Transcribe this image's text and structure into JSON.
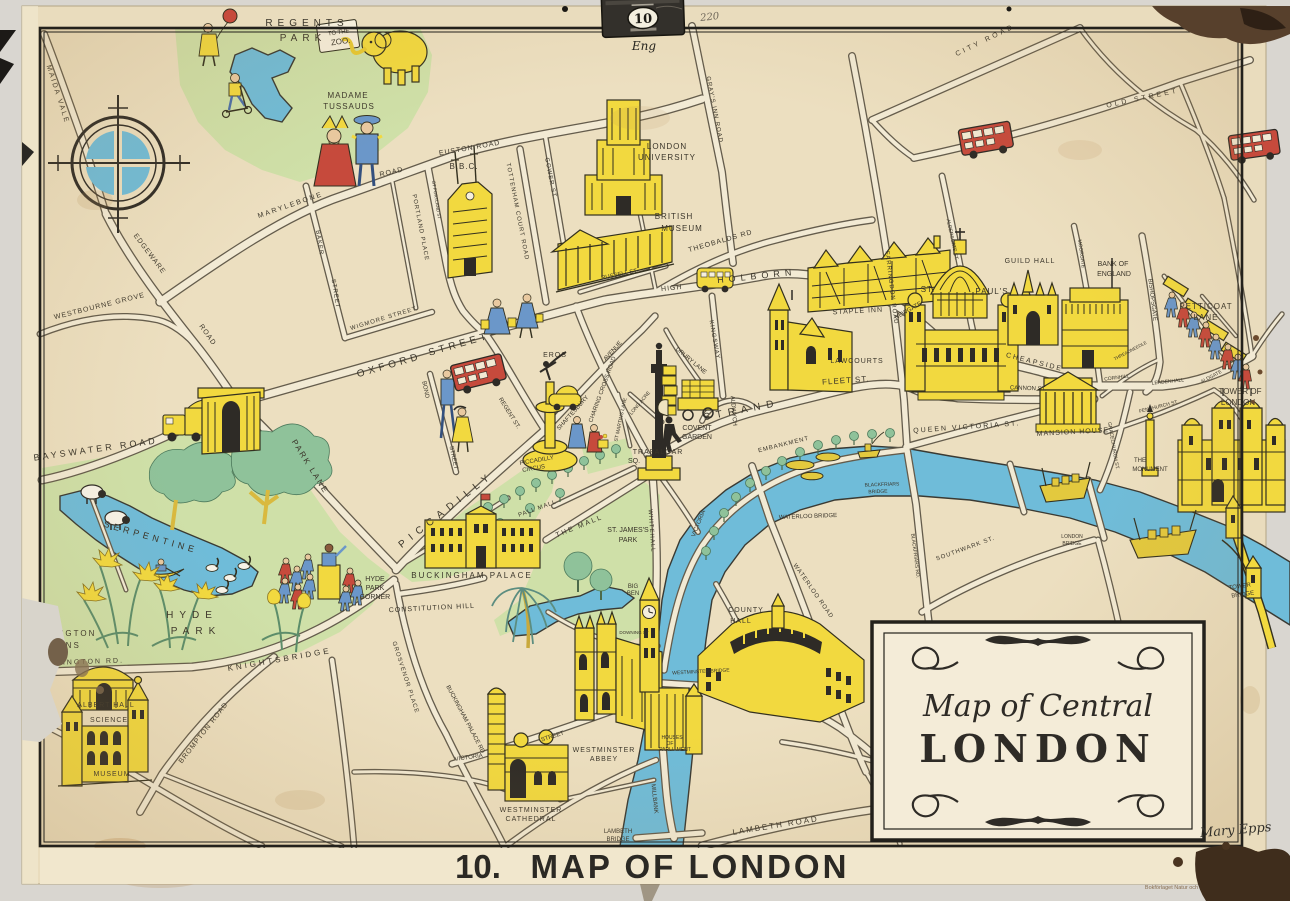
{
  "poster": {
    "hanger": {
      "number": "10",
      "note": "Eng",
      "pencil": "220"
    },
    "caption": {
      "number": "10.",
      "text": "MAP OF LONDON"
    },
    "cartouche": {
      "line1": "Map of Central",
      "line2": "LONDON"
    },
    "signature": "Mary Epps",
    "imprint": "A.B. KOPIA STOCKHOLM",
    "publisher": "Bokförlaget Natur och Kultur engelska planscherna"
  },
  "map": {
    "colors": {
      "cream": "#e9dcbd",
      "road": "#f2ead4",
      "park": "#cfe0a8",
      "water": "#6fbcd9",
      "landmark_yellow": "#f2d93f",
      "bus_red": "#c64a3c",
      "ink": "#3a352a"
    },
    "labels": [
      {
        "t": "REGENTS",
        "x": 307,
        "y": 26,
        "r": 0,
        "s": 10,
        "ls": 5
      },
      {
        "t": "PARK",
        "x": 303,
        "y": 41,
        "r": 0,
        "s": 10,
        "ls": 5
      },
      {
        "t": "TO THE",
        "x": 339,
        "y": 34,
        "r": -8,
        "s": 6,
        "ls": 0
      },
      {
        "t": "ZOO.",
        "x": 341,
        "y": 44,
        "r": -8,
        "s": 8,
        "ls": 0
      },
      {
        "t": "MADAME",
        "x": 348,
        "y": 98,
        "r": 0,
        "s": 8,
        "ls": 1
      },
      {
        "t": "TUSSAUDS",
        "x": 349,
        "y": 109,
        "r": 0,
        "s": 8,
        "ls": 1
      },
      {
        "t": "B.B.C.",
        "x": 464,
        "y": 169,
        "r": 0,
        "s": 8,
        "ls": 1
      },
      {
        "t": "LONDON",
        "x": 667,
        "y": 149,
        "r": 0,
        "s": 8,
        "ls": 1
      },
      {
        "t": "UNIVERSITY",
        "x": 667,
        "y": 160,
        "r": 0,
        "s": 8,
        "ls": 1
      },
      {
        "t": "BRITISH",
        "x": 674,
        "y": 219,
        "r": 0,
        "s": 8,
        "ls": 1
      },
      {
        "t": "MUSEUM",
        "x": 682,
        "y": 231,
        "r": 0,
        "s": 8,
        "ls": 1
      },
      {
        "t": "STAPLE INN",
        "x": 858,
        "y": 313,
        "r": -3,
        "s": 7,
        "ls": 1
      },
      {
        "t": "LAWCOURTS",
        "x": 857,
        "y": 363,
        "r": 0,
        "s": 7,
        "ls": 1
      },
      {
        "t": "ST.",
        "x": 928,
        "y": 292,
        "r": 0,
        "s": 8,
        "ls": 1
      },
      {
        "t": "PAUL'S",
        "x": 992,
        "y": 294,
        "r": 0,
        "s": 8,
        "ls": 1
      },
      {
        "t": "GUILD HALL",
        "x": 1030,
        "y": 263,
        "r": 0,
        "s": 7,
        "ls": 1
      },
      {
        "t": "BANK OF",
        "x": 1113,
        "y": 266,
        "r": 0,
        "s": 7,
        "ls": 0
      },
      {
        "t": "ENGLAND",
        "x": 1114,
        "y": 276,
        "r": 0,
        "s": 7,
        "ls": 0
      },
      {
        "t": "PETTICOAT",
        "x": 1206,
        "y": 309,
        "r": 0,
        "s": 8,
        "ls": 1
      },
      {
        "t": "LANE",
        "x": 1206,
        "y": 320,
        "r": 0,
        "s": 8,
        "ls": 1
      },
      {
        "t": "TOWER OF",
        "x": 1240,
        "y": 394,
        "r": 0,
        "s": 8,
        "ls": 0
      },
      {
        "t": "LONDON",
        "x": 1238,
        "y": 405,
        "r": 0,
        "s": 8,
        "ls": 0
      },
      {
        "t": "THE",
        "x": 1140,
        "y": 462,
        "r": 0,
        "s": 6,
        "ls": 0
      },
      {
        "t": "MONUMENT",
        "x": 1150,
        "y": 471,
        "r": 0,
        "s": 6,
        "ls": 0
      },
      {
        "t": "MANSION HOUSE",
        "x": 1073,
        "y": 434,
        "r": -3,
        "s": 7,
        "ls": 1
      },
      {
        "t": "COVENT",
        "x": 697,
        "y": 430,
        "r": 0,
        "s": 7,
        "ls": 0
      },
      {
        "t": "GARDEN",
        "x": 697,
        "y": 439,
        "r": 0,
        "s": 7,
        "ls": 0
      },
      {
        "t": "TRAFALGAR",
        "x": 658,
        "y": 454,
        "r": 0,
        "s": 7,
        "ls": 1
      },
      {
        "t": "SQ.",
        "x": 634,
        "y": 463,
        "r": 0,
        "s": 7,
        "ls": 0
      },
      {
        "t": "EROS",
        "x": 555,
        "y": 357,
        "r": 0,
        "s": 7,
        "ls": 1
      },
      {
        "t": "PICCADILLY",
        "x": 537,
        "y": 462,
        "r": -10,
        "s": 6,
        "ls": 0
      },
      {
        "t": "CIRCUS",
        "x": 534,
        "y": 470,
        "r": -10,
        "s": 6,
        "ls": 0
      },
      {
        "t": "HYDE",
        "x": 375,
        "y": 581,
        "r": 0,
        "s": 7,
        "ls": 0
      },
      {
        "t": "PARK",
        "x": 375,
        "y": 590,
        "r": 0,
        "s": 7,
        "ls": 0
      },
      {
        "t": "CORNER",
        "x": 375,
        "y": 599,
        "r": 0,
        "s": 7,
        "ls": 0
      },
      {
        "t": "HYDE",
        "x": 192,
        "y": 618,
        "r": 0,
        "s": 10,
        "ls": 6
      },
      {
        "t": "PARK",
        "x": 196,
        "y": 634,
        "r": 0,
        "s": 10,
        "ls": 6
      },
      {
        "t": "SERPENTINE",
        "x": 150,
        "y": 540,
        "r": 16,
        "s": 9,
        "ls": 4
      },
      {
        "t": "KENSINGTON",
        "x": 60,
        "y": 636,
        "r": 0,
        "s": 8,
        "ls": 2
      },
      {
        "t": "GARDENS",
        "x": 54,
        "y": 648,
        "r": 0,
        "s": 8,
        "ls": 2
      },
      {
        "t": "ST. JAMES'S",
        "x": 628,
        "y": 532,
        "r": 0,
        "s": 7,
        "ls": 0
      },
      {
        "t": "PARK",
        "x": 628,
        "y": 542,
        "r": 0,
        "s": 7,
        "ls": 0
      },
      {
        "t": "BIG",
        "x": 633,
        "y": 588,
        "r": 0,
        "s": 6,
        "ls": 0
      },
      {
        "t": "BEN",
        "x": 633,
        "y": 595,
        "r": 0,
        "s": 6,
        "ls": 0
      },
      {
        "t": "BUCKINGHAM PALACE",
        "x": 472,
        "y": 578,
        "r": 0,
        "s": 8,
        "ls": 2
      },
      {
        "t": "WESTMINSTER",
        "x": 604,
        "y": 752,
        "r": 0,
        "s": 7,
        "ls": 1
      },
      {
        "t": "ABBEY",
        "x": 604,
        "y": 761,
        "r": 0,
        "s": 7,
        "ls": 1
      },
      {
        "t": "HOUSES",
        "x": 672,
        "y": 739,
        "r": 0,
        "s": 5,
        "ls": 0
      },
      {
        "t": "OF",
        "x": 670,
        "y": 745,
        "r": 0,
        "s": 5,
        "ls": 0
      },
      {
        "t": "PARLIAMENT",
        "x": 675,
        "y": 751,
        "r": 0,
        "s": 5,
        "ls": 0
      },
      {
        "t": "WESTMINSTER",
        "x": 531,
        "y": 812,
        "r": 0,
        "s": 7,
        "ls": 1
      },
      {
        "t": "CATHEDRAL",
        "x": 531,
        "y": 821,
        "r": 0,
        "s": 7,
        "ls": 1
      },
      {
        "t": "COUNTY",
        "x": 746,
        "y": 612,
        "r": 0,
        "s": 7,
        "ls": 1
      },
      {
        "t": "HALL",
        "x": 741,
        "y": 623,
        "r": 0,
        "s": 7,
        "ls": 1
      },
      {
        "t": "ALBERT HALL",
        "x": 106,
        "y": 707,
        "r": 0,
        "s": 7,
        "ls": 1
      },
      {
        "t": "SCIENCE",
        "x": 109,
        "y": 722,
        "r": 0,
        "s": 7,
        "ls": 1
      },
      {
        "t": "MUSEUM",
        "x": 112,
        "y": 776,
        "r": 0,
        "s": 7,
        "ls": 1
      },
      {
        "t": "TOWER",
        "x": 1240,
        "y": 588,
        "r": -8,
        "s": 6,
        "ls": 0
      },
      {
        "t": "BRIDGE",
        "x": 1243,
        "y": 596,
        "r": -8,
        "s": 6,
        "ls": 0
      },
      {
        "t": "MAIDA VALE",
        "x": 56,
        "y": 95,
        "r": 72,
        "s": 7,
        "ls": 2
      },
      {
        "t": "WESTBOURNE GROVE",
        "x": 100,
        "y": 308,
        "r": -14,
        "s": 7,
        "ls": 1
      },
      {
        "t": "EDGEWARE",
        "x": 148,
        "y": 255,
        "r": 53,
        "s": 7,
        "ls": 1
      },
      {
        "t": "ROAD",
        "x": 206,
        "y": 336,
        "r": 55,
        "s": 7,
        "ls": 1
      },
      {
        "t": "MARYLEBONE",
        "x": 291,
        "y": 207,
        "r": -19,
        "s": 7,
        "ls": 2
      },
      {
        "t": "ROAD",
        "x": 392,
        "y": 174,
        "r": -13,
        "s": 7,
        "ls": 1
      },
      {
        "t": "EUSTON ROAD",
        "x": 470,
        "y": 150,
        "r": -10,
        "s": 7,
        "ls": 1
      },
      {
        "t": "BAKER",
        "x": 318,
        "y": 243,
        "r": 81,
        "s": 6,
        "ls": 1
      },
      {
        "t": "STREET",
        "x": 334,
        "y": 294,
        "r": 81,
        "s": 6,
        "ls": 1
      },
      {
        "t": "GT PORTLAND ST",
        "x": 435,
        "y": 200,
        "r": 81,
        "s": 4.5,
        "ls": 0
      },
      {
        "t": "PORTLAND PLACE",
        "x": 419,
        "y": 228,
        "r": 79,
        "s": 6,
        "ls": 1
      },
      {
        "t": "TOTTENHAM COURT ROAD",
        "x": 516,
        "y": 212,
        "r": 79,
        "s": 6,
        "ls": 1
      },
      {
        "t": "GOWER ST",
        "x": 549,
        "y": 178,
        "r": 79,
        "s": 6,
        "ls": 1
      },
      {
        "t": "WIGMORE STREET",
        "x": 384,
        "y": 320,
        "r": -17,
        "s": 6,
        "ls": 1
      },
      {
        "t": "OXFORD",
        "x": 390,
        "y": 368,
        "r": -16,
        "s": 10,
        "ls": 4
      },
      {
        "t": "STREET",
        "x": 460,
        "y": 347,
        "r": -16,
        "s": 10,
        "ls": 4
      },
      {
        "t": "BOND",
        "x": 424,
        "y": 390,
        "r": 78,
        "s": 6,
        "ls": 0
      },
      {
        "t": "STREET",
        "x": 452,
        "y": 458,
        "r": 78,
        "s": 6,
        "ls": 0
      },
      {
        "t": "REGENT ST.",
        "x": 508,
        "y": 414,
        "r": 58,
        "s": 6,
        "ls": 0
      },
      {
        "t": "SHAFTESBURY",
        "x": 574,
        "y": 414,
        "r": -48,
        "s": 6,
        "ls": 0
      },
      {
        "t": "AVENUE",
        "x": 614,
        "y": 352,
        "r": -48,
        "s": 6,
        "ls": 0
      },
      {
        "t": "CHARING CROSS ROAD",
        "x": 604,
        "y": 390,
        "r": -70,
        "s": 6,
        "ls": 0
      },
      {
        "t": "ST MARTINS LANE",
        "x": 622,
        "y": 420,
        "r": -78,
        "s": 5,
        "ls": 0
      },
      {
        "t": "LONG ACRE",
        "x": 641,
        "y": 404,
        "r": -50,
        "s": 5,
        "ls": 0
      },
      {
        "t": "DRURY LANE",
        "x": 690,
        "y": 362,
        "r": 40,
        "s": 6,
        "ls": 0
      },
      {
        "t": "KINGSWAY",
        "x": 713,
        "y": 340,
        "r": 80,
        "s": 6,
        "ls": 1
      },
      {
        "t": "ALDWYCH",
        "x": 732,
        "y": 411,
        "r": 85,
        "s": 6,
        "ls": 0
      },
      {
        "t": "STRAND",
        "x": 742,
        "y": 413,
        "r": -11,
        "s": 10,
        "ls": 6
      },
      {
        "t": "FLEET ST.",
        "x": 846,
        "y": 383,
        "r": -4,
        "s": 8,
        "ls": 1
      },
      {
        "t": "HIGH",
        "x": 672,
        "y": 290,
        "r": -6,
        "s": 7,
        "ls": 1
      },
      {
        "t": "HOLBORN",
        "x": 757,
        "y": 279,
        "r": -6,
        "s": 9,
        "ls": 5
      },
      {
        "t": "THEOBALDS RD",
        "x": 721,
        "y": 243,
        "r": -16,
        "s": 7,
        "ls": 1
      },
      {
        "t": "GRAY'S INN ROAD",
        "x": 713,
        "y": 110,
        "r": 79,
        "s": 6,
        "ls": 1
      },
      {
        "t": "RUSSELL ST.",
        "x": 620,
        "y": 276,
        "r": -12,
        "s": 6,
        "ls": 0
      },
      {
        "t": "NEWGATE",
        "x": 909,
        "y": 312,
        "r": -30,
        "s": 6,
        "ls": 0
      },
      {
        "t": "FARRINGDON ROAD",
        "x": 890,
        "y": 288,
        "r": 83,
        "s": 6,
        "ls": 1
      },
      {
        "t": "ALDERSGATE ST.",
        "x": 951,
        "y": 240,
        "r": 78,
        "s": 5,
        "ls": 0
      },
      {
        "t": "MOORGATE",
        "x": 1080,
        "y": 254,
        "r": 82,
        "s": 5,
        "ls": 0
      },
      {
        "t": "BISHOPSGATE",
        "x": 1151,
        "y": 300,
        "r": 83,
        "s": 6,
        "ls": 0
      },
      {
        "t": "CITY ROAD",
        "x": 986,
        "y": 42,
        "r": -26,
        "s": 7,
        "ls": 3
      },
      {
        "t": "OLD STREET",
        "x": 1143,
        "y": 100,
        "r": -12,
        "s": 7,
        "ls": 3
      },
      {
        "t": "CHEAPSIDE",
        "x": 1034,
        "y": 364,
        "r": 14,
        "s": 7,
        "ls": 2
      },
      {
        "t": "CANNON ST.",
        "x": 1028,
        "y": 390,
        "r": 2,
        "s": 6,
        "ls": 0
      },
      {
        "t": "QUEEN VICTORIA ST.",
        "x": 967,
        "y": 429,
        "r": -4,
        "s": 7,
        "ls": 2
      },
      {
        "t": "CORNHILL",
        "x": 1117,
        "y": 379,
        "r": -8,
        "s": 5,
        "ls": 0
      },
      {
        "t": "THREADNEEDLE",
        "x": 1131,
        "y": 352,
        "r": -28,
        "s": 4.5,
        "ls": 0
      },
      {
        "t": "LEADENHALL",
        "x": 1168,
        "y": 383,
        "r": -6,
        "s": 5,
        "ls": 0
      },
      {
        "t": "ALDGATE",
        "x": 1212,
        "y": 378,
        "r": -28,
        "s": 5,
        "ls": 0
      },
      {
        "t": "FENCHURCH ST.",
        "x": 1159,
        "y": 408,
        "r": -14,
        "s": 5,
        "ls": 0
      },
      {
        "t": "GRACECHURCH ST.",
        "x": 1112,
        "y": 446,
        "r": 80,
        "s": 5,
        "ls": 0
      },
      {
        "t": "PICCADILLY",
        "x": 448,
        "y": 512,
        "r": -38,
        "s": 10,
        "ls": 6
      },
      {
        "t": "PALL MALL",
        "x": 538,
        "y": 510,
        "r": -20,
        "s": 6,
        "ls": 1
      },
      {
        "t": "THE MALL",
        "x": 580,
        "y": 528,
        "r": -22,
        "s": 7,
        "ls": 2
      },
      {
        "t": "CONSTITUTION HILL",
        "x": 432,
        "y": 610,
        "r": -3,
        "s": 7,
        "ls": 1
      },
      {
        "t": "GROSVENOR PLACE",
        "x": 404,
        "y": 678,
        "r": 72,
        "s": 6,
        "ls": 1
      },
      {
        "t": "BUCKINGHAM PALACE RD",
        "x": 464,
        "y": 720,
        "r": 62,
        "s": 6,
        "ls": 0
      },
      {
        "t": "VICTORIA",
        "x": 469,
        "y": 759,
        "r": -8,
        "s": 6,
        "ls": 0
      },
      {
        "t": "STREET",
        "x": 553,
        "y": 738,
        "r": -18,
        "s": 6,
        "ls": 0
      },
      {
        "t": "WHITEHALL",
        "x": 650,
        "y": 531,
        "r": 86,
        "s": 6,
        "ls": 1
      },
      {
        "t": "DOWNING ST",
        "x": 634,
        "y": 634,
        "r": 0,
        "s": 4.5,
        "ls": 0
      },
      {
        "t": "MILLBANK",
        "x": 653,
        "y": 799,
        "r": 84,
        "s": 6,
        "ls": 0
      },
      {
        "t": "LAMBETH",
        "x": 618,
        "y": 833,
        "r": 0,
        "s": 6,
        "ls": 0
      },
      {
        "t": "BRIDGE",
        "x": 618,
        "y": 841,
        "r": 0,
        "s": 6,
        "ls": 0
      },
      {
        "t": "LAMBETH ROAD",
        "x": 776,
        "y": 828,
        "r": -9,
        "s": 8,
        "ls": 2
      },
      {
        "t": "WESTMINSTER BRIDGE",
        "x": 701,
        "y": 673,
        "r": -3,
        "s": 5,
        "ls": 0
      },
      {
        "t": "BAYSWATER ROAD",
        "x": 96,
        "y": 452,
        "r": -8,
        "s": 9,
        "ls": 3
      },
      {
        "t": "PARK LANE",
        "x": 308,
        "y": 468,
        "r": 58,
        "s": 8,
        "ls": 2
      },
      {
        "t": "KNIGHTSBRIDGE",
        "x": 280,
        "y": 662,
        "r": -10,
        "s": 8,
        "ls": 3
      },
      {
        "t": "KENSINGTON RD.",
        "x": 80,
        "y": 664,
        "r": -2,
        "s": 7,
        "ls": 2
      },
      {
        "t": "BROMPTON ROAD",
        "x": 205,
        "y": 734,
        "r": -52,
        "s": 7,
        "ls": 1
      },
      {
        "t": "VICTORIA",
        "x": 700,
        "y": 524,
        "r": -68,
        "s": 6,
        "ls": 0
      },
      {
        "t": "EMBANKMENT",
        "x": 784,
        "y": 446,
        "r": -14,
        "s": 6,
        "ls": 1
      },
      {
        "t": "WATERLOO BRIDGE",
        "x": 808,
        "y": 518,
        "r": -2,
        "s": 6,
        "ls": 0
      },
      {
        "t": "BLACKFRIARS",
        "x": 882,
        "y": 486,
        "r": -2,
        "s": 5,
        "ls": 0
      },
      {
        "t": "BRIDGE",
        "x": 878,
        "y": 493,
        "r": -2,
        "s": 5,
        "ls": 0
      },
      {
        "t": "SOUTHWARK ST.",
        "x": 966,
        "y": 550,
        "r": -20,
        "s": 6,
        "ls": 1
      },
      {
        "t": "BLACKFRIARS RD.",
        "x": 914,
        "y": 556,
        "r": 83,
        "s": 5,
        "ls": 0
      },
      {
        "t": "WATERLOO ROAD",
        "x": 812,
        "y": 592,
        "r": 55,
        "s": 6,
        "ls": 1
      },
      {
        "t": "LONDON",
        "x": 1072,
        "y": 538,
        "r": 0,
        "s": 5,
        "ls": 0
      },
      {
        "t": "BRIDGE",
        "x": 1072,
        "y": 545,
        "r": 0,
        "s": 5,
        "ls": 0
      }
    ]
  }
}
